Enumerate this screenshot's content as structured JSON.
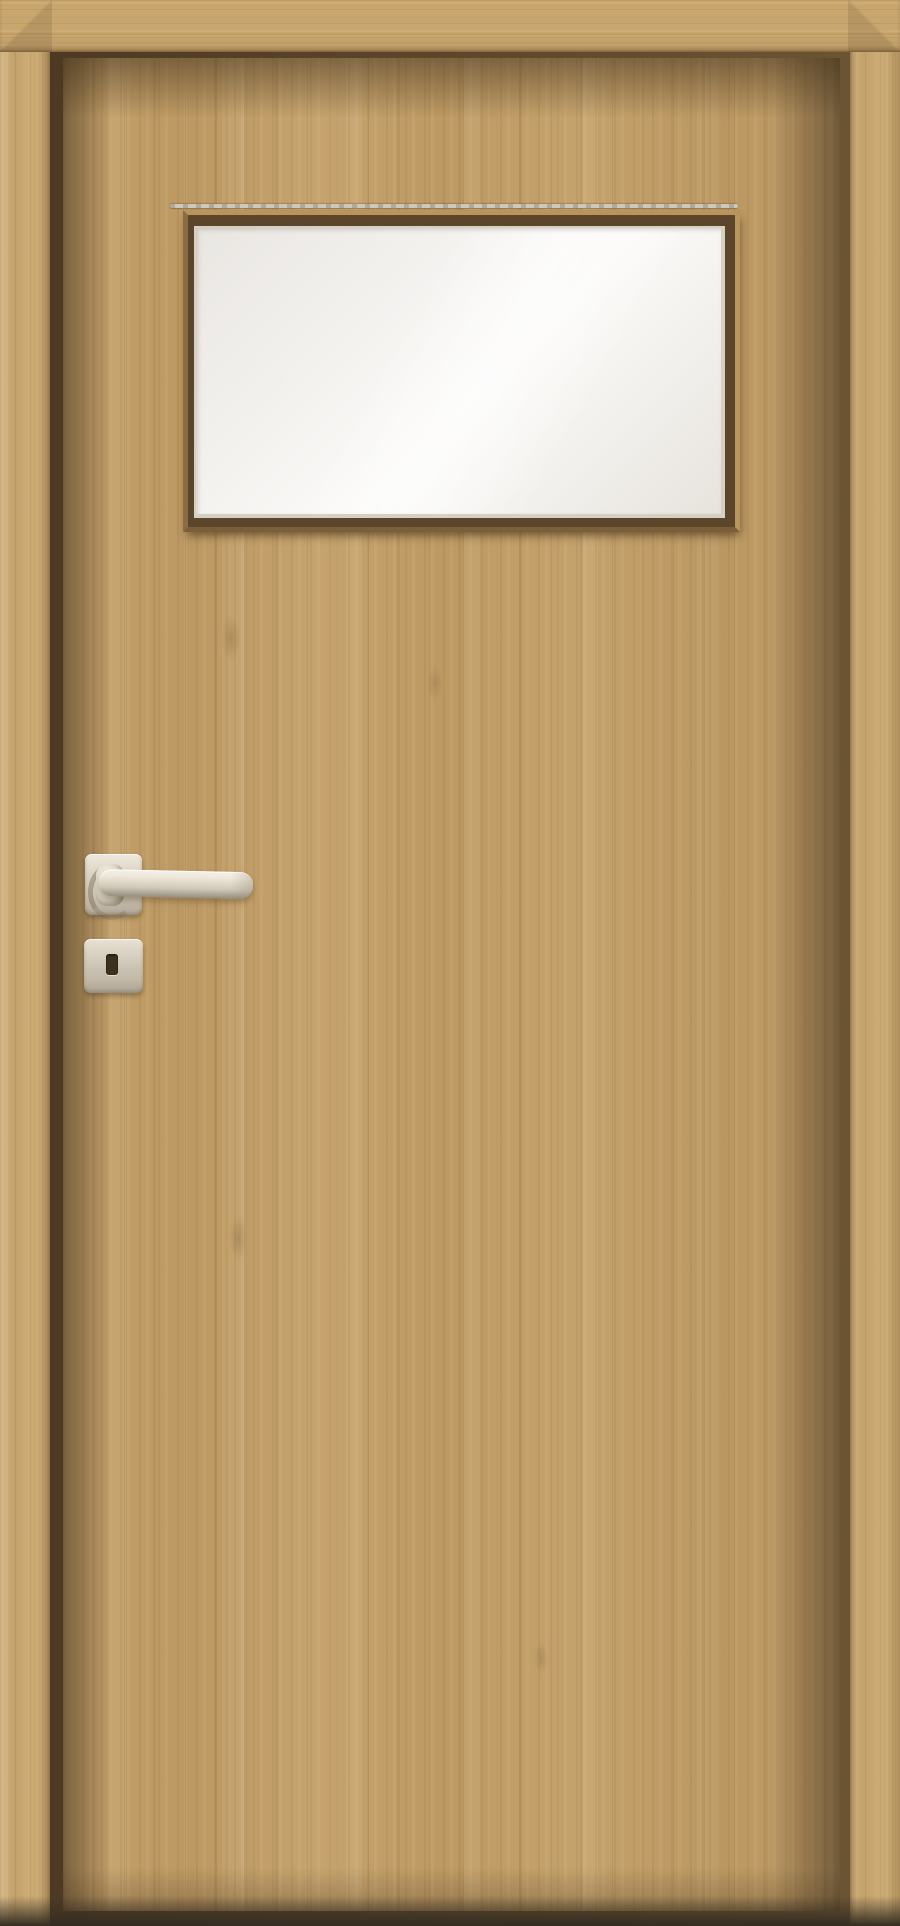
{
  "scene": {
    "title": "Product photo: wooden interior door, oak finish, with frosted glass panel",
    "objects": {
      "door_frame": "Door frame casing (oak)",
      "door_leaf": "Door leaf (oak, vertical grain)",
      "rebate_gap": "Shadow gap between leaf and frame",
      "groove": "Decorative groove line above glazing",
      "glazing_frame": "Glazing bead frame",
      "glass_panel": "Frosted glass panel",
      "handle_rosette": "Square handle rosette (satin metal)",
      "handle_neck": "Handle neck",
      "handle_lever": "Straight lever handle (satin metal)",
      "escutcheon": "Square key escutcheon (satin metal)",
      "keyhole": "Keyhole slot",
      "floor_shadow": "Shadow at floor line"
    }
  },
  "colors": {
    "casing": "#c8a66e",
    "leaf": "#c19d66",
    "gap": "#4e3a23",
    "gap-light": "#6b5433",
    "groove": "#cdc8ba",
    "bead-dark": "#5b462b",
    "bevel-light": "#d6d0c3",
    "glass-bright": "#fbfaf8",
    "glass-dim": "#e8e4df",
    "metal-light": "#efe9dc",
    "metal-mid": "#cfc7b7",
    "metal-dark": "#968c7b",
    "keyhole": "#3e301c",
    "floor": "#352d22"
  }
}
